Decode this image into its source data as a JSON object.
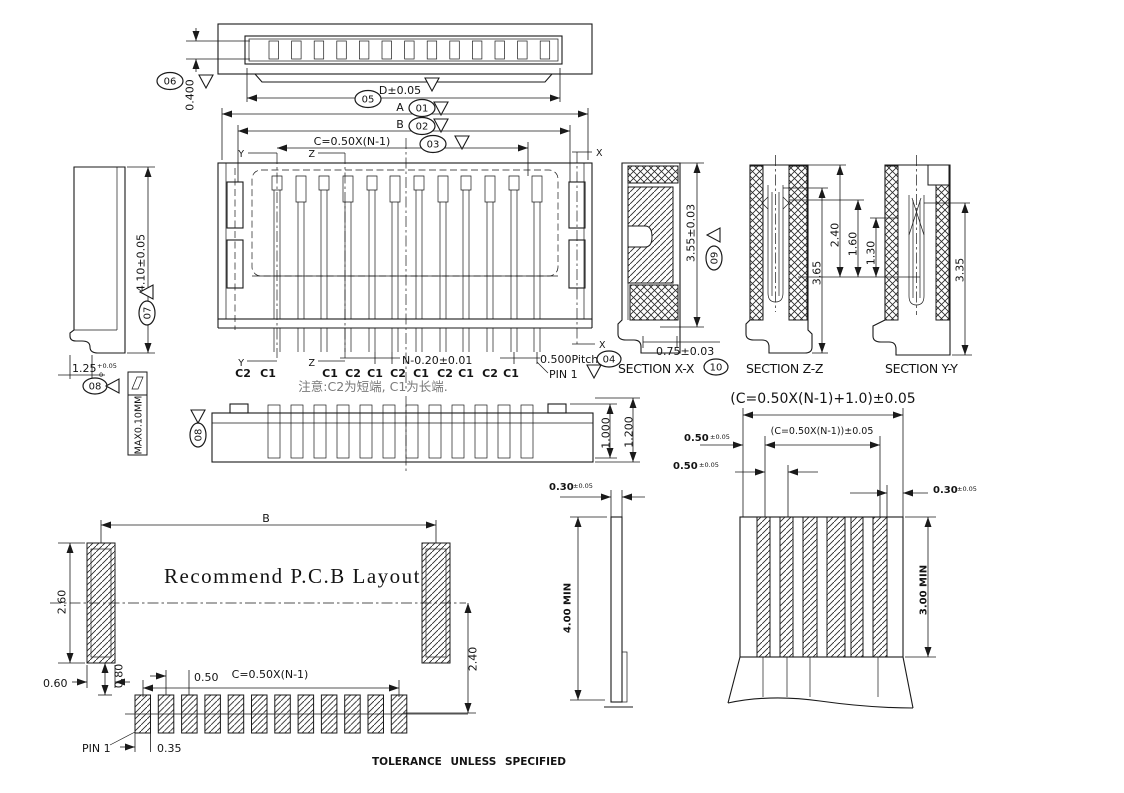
{
  "top_view": {
    "dim_height": "0.400",
    "balloon": "06",
    "dim_d": "D±0.05",
    "balloon_d": "05"
  },
  "dims": {
    "a": "A",
    "balloon_a": "01",
    "b": "B",
    "balloon_b": "02",
    "c": "C=0.50X(N-1)",
    "balloon_c": "03"
  },
  "cuts": {
    "x": "X",
    "y": "Y",
    "z": "Z"
  },
  "front_view": {
    "pin_labels": [
      "C2",
      "C1",
      "C1",
      "C2",
      "C1",
      "C2",
      "C1",
      "C2",
      "C1",
      "C2",
      "C1"
    ],
    "dim_n": "N-0.20±0.01",
    "pitch": "0.500Pitch",
    "balloon_pitch": "04",
    "pin1": "PIN 1",
    "note": "注意:C2为短端, C1为长端."
  },
  "side_view": {
    "dim_height": "4.10±0.05",
    "balloon_height": "07",
    "dim_width": "1.25",
    "tol_plus": "+0.05",
    "tol_minus": "0",
    "balloon_flat": "08",
    "flatness": "MAX0.10MM"
  },
  "bottom_view": {
    "balloon": "08",
    "dim_inner": "1.000",
    "dim_outer": "1.200"
  },
  "sections": {
    "xx": {
      "title": "SECTION X-X",
      "dim_height": "3.55±0.03",
      "balloon_height": "09",
      "dim_foot": "0.75±0.03",
      "balloon_foot": "10"
    },
    "zz": {
      "title": "SECTION Z-Z",
      "d365": "3.65",
      "d240": "2.40",
      "d160": "1.60",
      "d130": "1.30"
    },
    "yy": {
      "title": "SECTION Y-Y",
      "d335": "3.35"
    }
  },
  "fpc": {
    "dim_total": "(C=0.50X(N-1)+1.0)±0.05",
    "dim_c": "(C=0.50X(N-1))±0.05",
    "d050": "0.50",
    "d050_tol": "±0.05",
    "d030": "0.30",
    "d030_tol": "±0.05",
    "min4": "4.00 MIN",
    "min3": "3.00 MIN"
  },
  "pcb": {
    "title": "Recommend P.C.B Layout",
    "b": "B",
    "d260": "2.60",
    "d240": "2.40",
    "d060": "0.60",
    "d080": "0.80",
    "c": "C=0.50X(N-1)",
    "d050": "0.50",
    "d035": "0.35",
    "pin1": "PIN 1"
  },
  "footer": {
    "tolerance": "TOLERANCE UNLESS SPECIFIED"
  }
}
